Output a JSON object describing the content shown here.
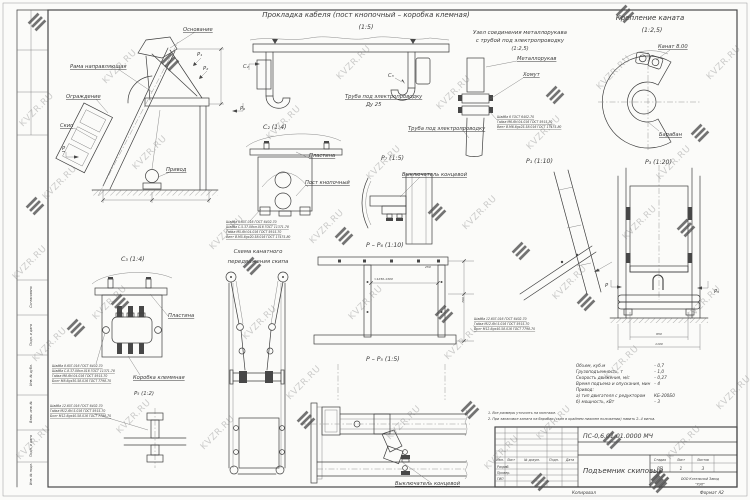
{
  "watermark": "KVZR.RU",
  "titles": {
    "cable": "Прокладка кабеля (пост кнопочный – коробка клемная)",
    "cable_scale": "(1:5)",
    "hose1": "Узел соединения металлорукава",
    "hose2": "с трубой под электропроводку",
    "hose_scale": "(1:2,5)",
    "rope": "Крепление каната",
    "rope_scale": "(1:2,5)",
    "scheme1": "Схема канатного",
    "scheme2": "передвижения скипа"
  },
  "view_labels": {
    "c2_head": "С₂ (1:4)",
    "c3_head": "С₃ (1:4)",
    "p5_head": "Р₅ (1:2)",
    "p7_head": "Р₇ (1:5)",
    "p1_head": "Р₁ (1:10)",
    "p3_head": "Р₃ (1:20)",
    "pp6_head": "Р – Р₆ (1:10)",
    "pp5_head": "Р – Р₅ (1:5)",
    "arrow_p": "Р",
    "arrow_p1": "Р₁",
    "arrow_p2": "Р₂",
    "arrow_p6": "Р₆",
    "arrow_p5": "Р₅",
    "arrow_c2": "С₂",
    "arrow_c3": "С₃"
  },
  "labels": {
    "osnovanie": "Основание",
    "rama": "Рама направляющая",
    "ograzhdenie": "Ограждение",
    "skip": "Скип",
    "privod": "Привод",
    "truba": "Труба под электропроводку",
    "du25": "Ду 25",
    "metallorukav": "Металлорукав",
    "khomut": "Хомут",
    "truba2": "Труба под электропроводку",
    "kanat": "Канат 8.00",
    "baraban": "Барабан",
    "plastina": "Пластина",
    "post": "Пост кнопочный",
    "vykl": "Выключатель концевой",
    "plastina2": "Пластина",
    "korobka": "Коробка клеммная",
    "vykl2": "Выключатель концевой"
  },
  "fasteners": {
    "c2": [
      "Шайба 5.65Г.016 ГОСТ 6402-70",
      "Шайба С.5.37.08кп.016 ГОСТ 11371-78",
      "Гайка М5-6Н.04.016 ГОСТ 5915-70",
      "Винт В.М5-6gх20.58.016 ГОСТ 17475-80"
    ],
    "c3": [
      "Шайба 8.65Г.016 ГОСТ 6402-70",
      "Шайба С.8.37.08кп.016 ГОСТ 11371-78",
      "Гайка М8-6Н.04.016 ГОСТ 5915-70",
      "Болт М8-6gх30.58.016 ГОСТ 7798-70"
    ],
    "p5": [
      "Шайба 12.65Г.016 ГОСТ 6402-70",
      "Гайка М12-6Н.5.016 ГОСТ 5915-70",
      "Болт М12-6gх40.58.016 ГОСТ 7798-70"
    ],
    "hose": [
      "Шайба 6 ГОСТ 6402-70",
      "Гайка М6-6Н.04.016 ГОСТ 5915-70",
      "Винт В.М6-6gх25.58.016 ГОСТ 17475-80"
    ],
    "pp5": [
      "Шайба 12.65Г.016 ГОСТ 6402-70",
      "Гайка М12-6Н.5.016 ГОСТ 5915-70",
      "Болт М12-6gх40.58.016 ГОСТ 7798-70"
    ]
  },
  "dims": {
    "pp6_w": "≈1250-1300",
    "pp6_d1": "250",
    "pp6_d2": "790",
    "p3_d1": "950",
    "p3_d2": "1100"
  },
  "specs": {
    "rows": [
      {
        "name": "Объем, куб.м",
        "value": "– 0,7"
      },
      {
        "name": "Грузоподъемность, т",
        "value": "– 1,0"
      },
      {
        "name": "Скорость движения, м/с",
        "value": "– 0,27"
      },
      {
        "name": "Время подъема и опускания, мин",
        "value": "– 4"
      },
      {
        "name": "Привод:",
        "value": ""
      },
      {
        "name": "а) тип двигателя с редуктором",
        "value": "КБ-200Б0"
      },
      {
        "name": "б) мощность, кВт",
        "value": "– 3"
      }
    ]
  },
  "notes": [
    "1. Все размеры уточнить на монтаже.",
    "2. При запасовке каната на барабан (скип в крайнем нижнем положении) навить 2..4 витка."
  ],
  "title_block": {
    "doc_number": "ПС-0,6.01.01.0000 МЧ",
    "title": "Подъемник скиповый",
    "stage_label": "Стадия",
    "stage": "РП",
    "sheet_label": "Лист",
    "sheet": "1",
    "sheets_label": "Листов",
    "sheets": "3",
    "company1": "ООО Котельный Завод",
    "company2": "\"РЭП\"",
    "cols": {
      "izm": "Изм.",
      "list": "Лист",
      "ndoc": "№ докум.",
      "podp": "Подп.",
      "data": "Дата"
    },
    "roles": [
      "Разраб.",
      "Провер.",
      "ГИП"
    ]
  },
  "side_strip": [
    "Согласовано",
    "Подп. и дата",
    "Инв. № дубл.",
    "Взам. инв. №",
    "Подп. и дата",
    "Инв. № подл."
  ],
  "footer": {
    "kopiroval": "Копировал",
    "format": "Формат А2"
  }
}
